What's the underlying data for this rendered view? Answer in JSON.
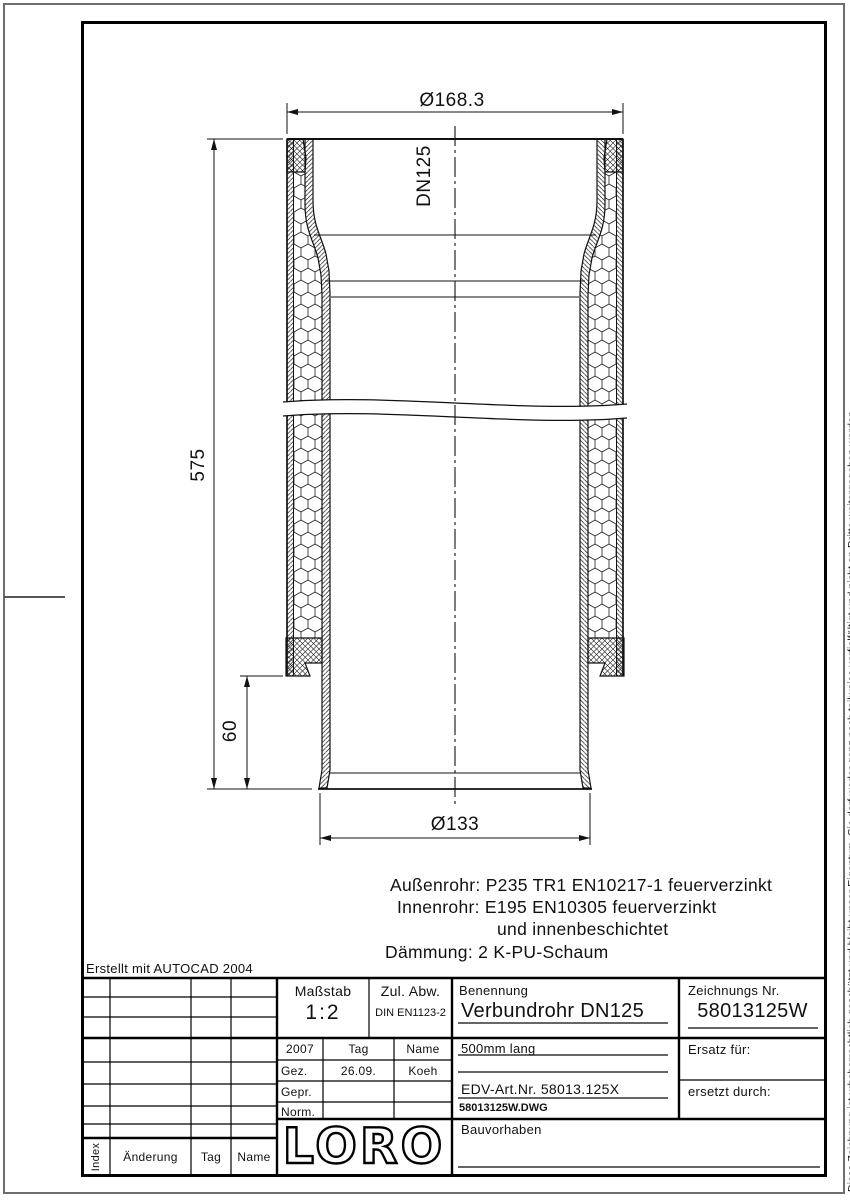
{
  "drawing": {
    "dimensions": {
      "outer_diameter": "Ø168.3",
      "nominal": "DN125",
      "length": "575",
      "spigot_length": "60",
      "inner_diameter": "Ø133"
    },
    "materials": [
      "Außenrohr:  P235 TR1 EN10217-1 feuerverzinkt",
      "Innenrohr:  E195 EN10305 feuerverzinkt",
      "und innenbeschichtet",
      "Dämmung:  2 K-PU-Schaum"
    ],
    "created_with": "Erstellt mit AUTOCAD 2004"
  },
  "title_block": {
    "massstab_label": "Maßstab",
    "massstab_value": "1:2",
    "zul_abw_label": "Zul. Abw.",
    "zul_abw_value": "DIN EN1123-2",
    "benennung_label": "Benennung",
    "benennung_value": "Verbundrohr DN125",
    "zeichnungs_nr_label": "Zeichnungs Nr.",
    "zeichnungs_nr_value": "58013125W",
    "subtitle": "500mm lang",
    "edv_art_nr": "EDV-Art.Nr. 58013.125X",
    "dwg_file": "58013125W.DWG",
    "ersatz_fuer_label": "Ersatz für:",
    "ersetzt_durch_label": "ersetzt durch:",
    "bauvorhaben_label": "Bauvorhaben",
    "logo": "LORO",
    "approval": {
      "year": "2007",
      "col_tag": "Tag",
      "col_name": "Name",
      "rows": [
        {
          "label": "Gez.",
          "tag": "26.09.",
          "name": "Koeh"
        },
        {
          "label": "Gepr.",
          "tag": "",
          "name": ""
        },
        {
          "label": "Norm.",
          "tag": "",
          "name": ""
        }
      ]
    }
  },
  "revision_table": {
    "col_index": "Index",
    "col_aenderung": "Änderung",
    "col_tag": "Tag",
    "col_name": "Name"
  },
  "copyright_vertical": "Diese Zeichnung ist urheberrechtlich geschützt und bleibt unser Eigentum. Sie darf weder ganz noch teilweise verfielfältigt und nicht an Dritte weitergegeben werden."
}
